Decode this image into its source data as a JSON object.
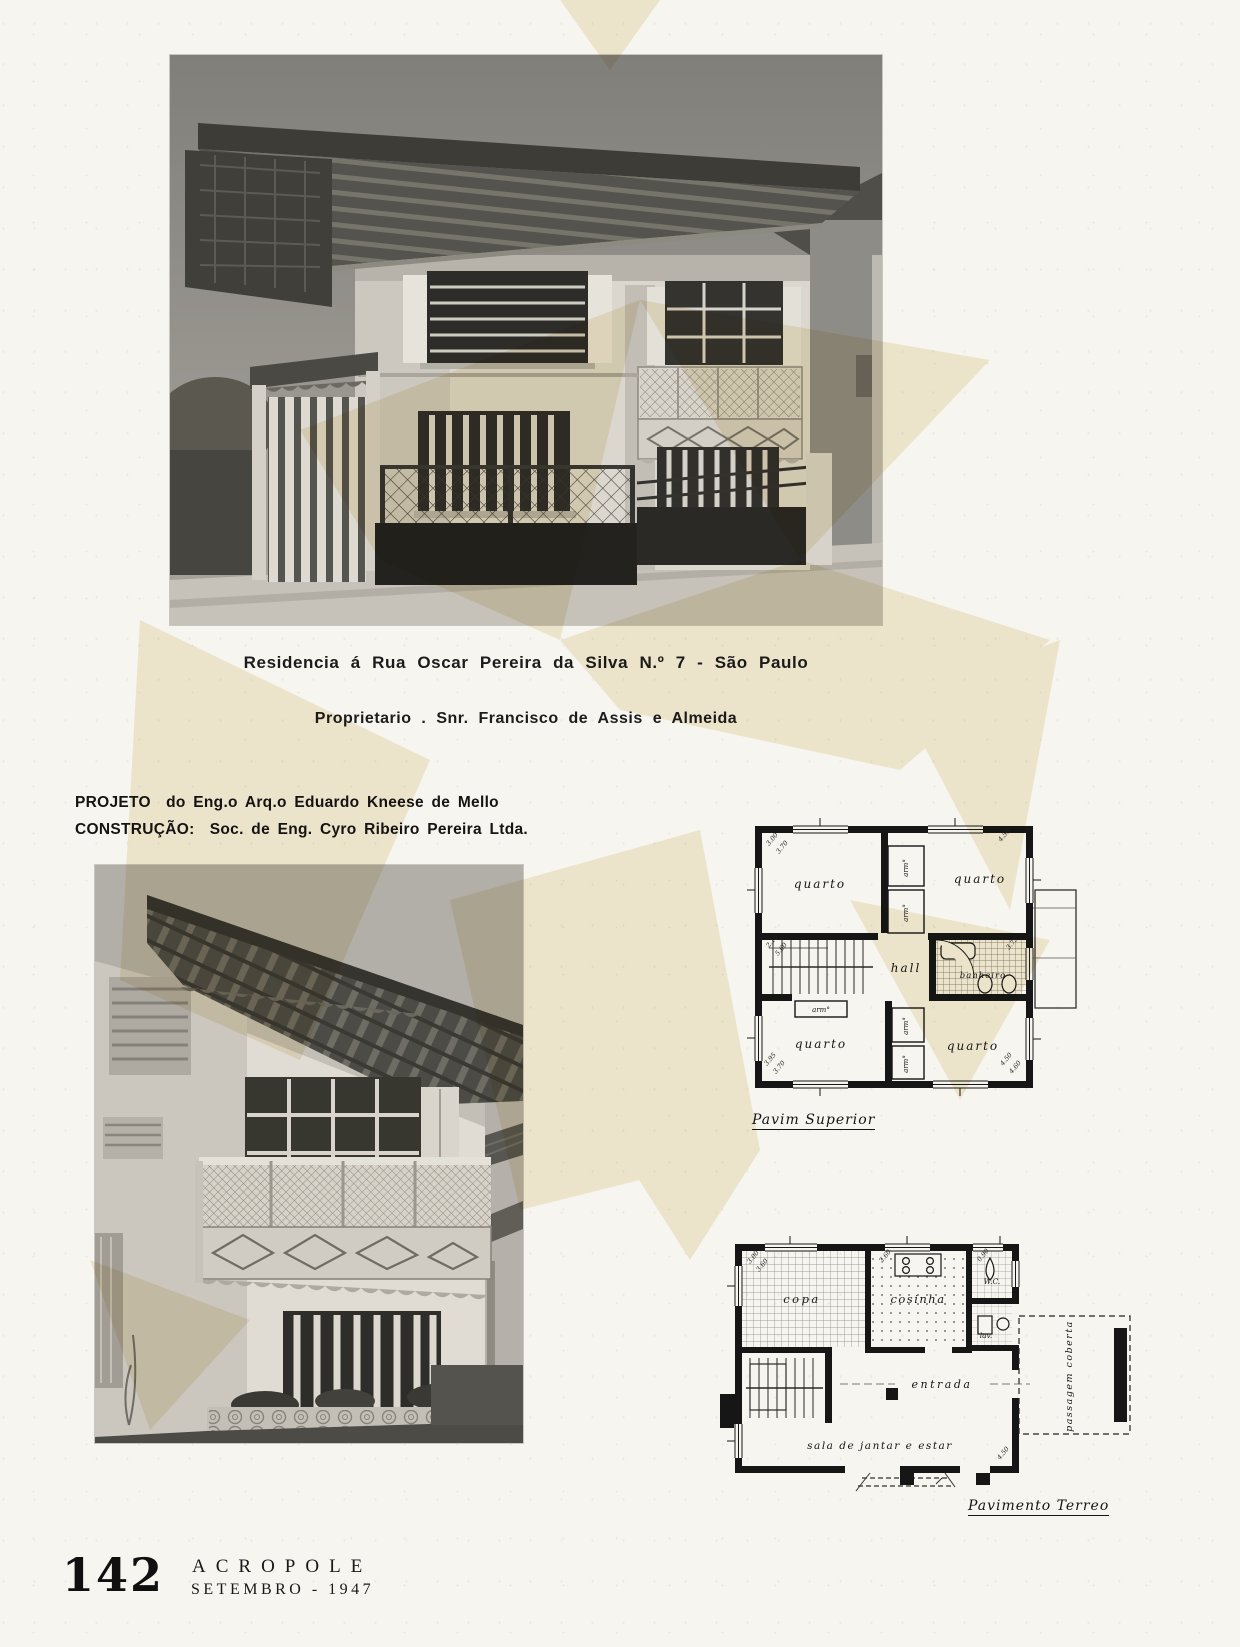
{
  "captions": {
    "address": "Residencia á Rua Oscar Pereira da Silva N.º 7 - São Paulo",
    "owner": "Proprietario . Snr. Francisco de Assis e Almeida"
  },
  "credits": {
    "project_label": "PROJETO",
    "project_rest": "do Eng.o Arq.o Eduardo Kneese de Mello",
    "construction_label": "CONSTRUÇÃO:",
    "construction_rest": "Soc. de Eng. Cyro Ribeiro Pereira Ltda."
  },
  "plans": {
    "upper": {
      "caption": "Pavim Superior",
      "rooms": {
        "tl": "quarto",
        "tr": "quarto",
        "hall": "hall",
        "bath": "banheiro",
        "bl": "quarto",
        "br": "quarto"
      },
      "closet": "arm°",
      "dims": [
        "3.00",
        "3.70",
        "4.50",
        "2.15",
        "5.60",
        "3.75",
        "3.95",
        "3.70",
        "4.50",
        "4.60"
      ]
    },
    "ground": {
      "caption": "Pavimento Terreo",
      "rooms": {
        "copa": "copa",
        "kitchen": "cosinha",
        "wc": "W.C.",
        "lav": "lav.",
        "entry": "entrada",
        "living": "sala de jantar e estar"
      },
      "passage": "passagem coberta",
      "dims": [
        "3.00",
        "3.60",
        "2.60",
        "0.90",
        "4.50"
      ]
    }
  },
  "footer": {
    "page_number": "142",
    "magazine": "ACROPOLE",
    "issue": "SETEMBRO  -  1947"
  }
}
